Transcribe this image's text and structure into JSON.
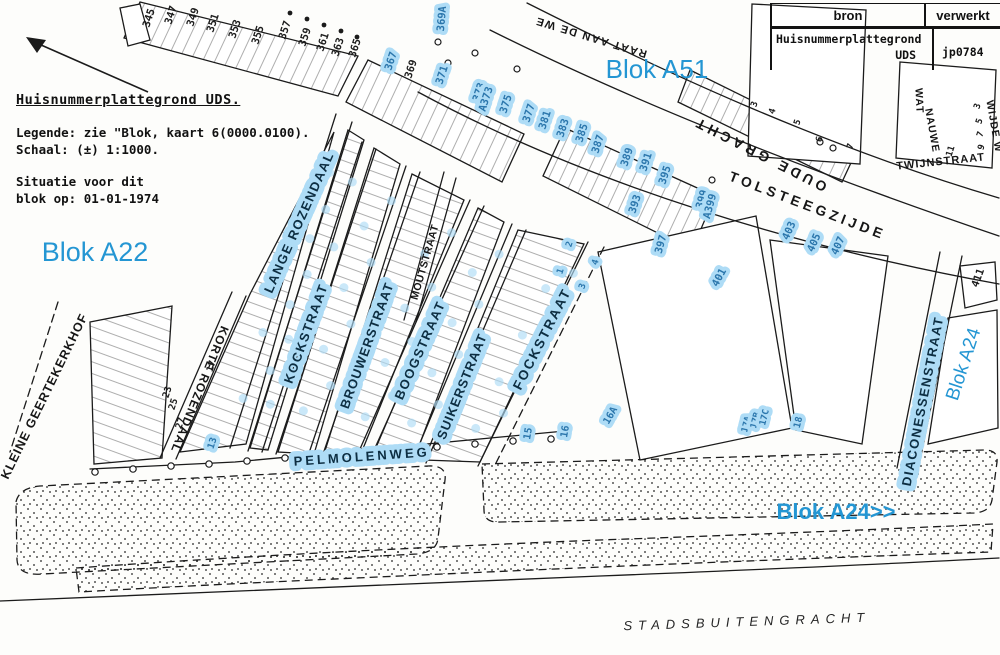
{
  "colors": {
    "annotation_blue": "#2496d3",
    "highlight": "#aedcf6",
    "ink": "#1b1b1b"
  },
  "legend": {
    "title": "Huisnummerplattegrond UDS.",
    "line1": "Legende: zie \"Blok, kaart 6(0000.0100).",
    "line2": "Schaal: (±) 1:1000.",
    "line3": "Situatie voor dit",
    "line4": "blok op: 01-01-1974"
  },
  "info_table": {
    "col1_header": "bron",
    "col2_header": "verwerkt",
    "source_line1": "Huisnummerplattegrond",
    "source_line2": "UDS",
    "value": "jp0784"
  },
  "map": {
    "blok_labels": [
      {
        "text": "Blok A22",
        "x": 95,
        "y": 261,
        "size": 27,
        "rot": 0,
        "bold": false
      },
      {
        "text": "Blok A51",
        "x": 657,
        "y": 78,
        "size": 26,
        "rot": 0,
        "bold": false
      },
      {
        "text": "Blok A24>>",
        "x": 836,
        "y": 519,
        "size": 22,
        "rot": 0,
        "bold": true
      },
      {
        "text": "Blok A24",
        "x": 969,
        "y": 366,
        "size": 19,
        "rot": -72,
        "bold": false
      }
    ],
    "street_labels": [
      {
        "text": "KLEINE GEERTEKERKHOF",
        "x": 48,
        "y": 398,
        "rot": -64,
        "size": 12.5,
        "ls": 1,
        "hl": false
      },
      {
        "text": "KORTE ROZENDAAL",
        "x": 196,
        "y": 388,
        "rot": 112,
        "size": 12,
        "ls": 1,
        "hl": false
      },
      {
        "text": "LANGE ROZENDAAL",
        "x": 303,
        "y": 224,
        "rot": -66,
        "size": 13,
        "ls": 1.5,
        "hl": true
      },
      {
        "text": "KOCKSTRAAT",
        "x": 310,
        "y": 335,
        "rot": -70,
        "size": 13,
        "ls": 1.5,
        "hl": true
      },
      {
        "text": "MOUTSTRAAT",
        "x": 428,
        "y": 263,
        "rot": -74,
        "size": 10.5,
        "ls": 0.5,
        "hl": false
      },
      {
        "text": "BROUWERSTRAAT",
        "x": 371,
        "y": 347,
        "rot": -70,
        "size": 13,
        "ls": 1,
        "hl": true
      },
      {
        "text": "BOOGSTRAAT",
        "x": 424,
        "y": 352,
        "rot": -66,
        "size": 13,
        "ls": 1.5,
        "hl": true
      },
      {
        "text": "SUIKERSTRAAT",
        "x": 466,
        "y": 388,
        "rot": -68,
        "size": 13,
        "ls": 1,
        "hl": true
      },
      {
        "text": "FOCKSTRAAT",
        "x": 546,
        "y": 341,
        "rot": -63,
        "size": 13.5,
        "ls": 2,
        "hl": true
      },
      {
        "text": "OUDE GRACHT",
        "x": 762,
        "y": 150,
        "rot": 207,
        "size": 14,
        "ls": 4,
        "hl": false
      },
      {
        "text": "TOLSTEEGZIJDE",
        "x": 806,
        "y": 210,
        "rot": 21,
        "size": 14,
        "ls": 4,
        "hl": false
      },
      {
        "text": "DIACONESSENSTRAAT",
        "x": 927,
        "y": 402,
        "rot": -79,
        "size": 13,
        "ls": 1.5,
        "hl": true
      },
      {
        "text": "PELMOLENWEG",
        "x": 362,
        "y": 461,
        "rot": -4,
        "size": 13,
        "ls": 3,
        "hl": true
      },
      {
        "text": "TWIJNSTRAAT",
        "x": 941,
        "y": 165,
        "rot": -6,
        "size": 11,
        "ls": 1,
        "hl": false
      },
      {
        "text": "NAUWE",
        "x": 929,
        "y": 131,
        "rot": 80,
        "size": 10.5,
        "ls": 1,
        "hl": false
      },
      {
        "text": "WAT",
        "x": 916,
        "y": 101,
        "rot": 87,
        "size": 10.5,
        "ls": 1,
        "hl": false
      },
      {
        "text": "WIJDE W",
        "x": 991,
        "y": 127,
        "rot": 80,
        "size": 10.5,
        "ls": 1,
        "hl": false
      }
    ],
    "partial_label": {
      "text": "RAAT AAN DE WE",
      "x": 592,
      "y": 34,
      "rot": 197,
      "size": 11,
      "ls": 1.5
    },
    "waterway_label": {
      "text": "STADSBUITENGRACHT",
      "x": 747,
      "y": 626,
      "rot": -2,
      "size": 13,
      "ls": 6
    },
    "house_numbers": [
      {
        "t": "345",
        "x": 152,
        "y": 19
      },
      {
        "t": "347",
        "x": 174,
        "y": 16
      },
      {
        "t": "349",
        "x": 196,
        "y": 18
      },
      {
        "t": "351",
        "x": 216,
        "y": 24
      },
      {
        "t": "353",
        "x": 238,
        "y": 30
      },
      {
        "t": "355",
        "x": 261,
        "y": 36
      },
      {
        "t": "357",
        "x": 288,
        "y": 31
      },
      {
        "t": "359",
        "x": 308,
        "y": 38
      },
      {
        "t": "361",
        "x": 326,
        "y": 43
      },
      {
        "t": "363",
        "x": 341,
        "y": 48
      },
      {
        "t": "365",
        "x": 358,
        "y": 49
      },
      {
        "t": "367",
        "x": 394,
        "y": 62,
        "hl": 1
      },
      {
        "t": "369",
        "x": 414,
        "y": 70
      },
      {
        "t": "369A",
        "x": 445,
        "y": 19,
        "hl": 1,
        "r": -85
      },
      {
        "t": "371",
        "x": 445,
        "y": 76,
        "hl": 1
      },
      {
        "t": "373",
        "x": 482,
        "y": 93,
        "hl": 1
      },
      {
        "t": "A373",
        "x": 489,
        "y": 100,
        "hl": 1
      },
      {
        "t": "375",
        "x": 509,
        "y": 105,
        "hl": 1
      },
      {
        "t": "377",
        "x": 532,
        "y": 114,
        "hl": 1
      },
      {
        "t": "381",
        "x": 548,
        "y": 121,
        "hl": 1
      },
      {
        "t": "383",
        "x": 566,
        "y": 129,
        "hl": 1
      },
      {
        "t": "385",
        "x": 585,
        "y": 134,
        "hl": 1
      },
      {
        "t": "387",
        "x": 601,
        "y": 145,
        "hl": 1
      },
      {
        "t": "389",
        "x": 630,
        "y": 158,
        "hl": 1
      },
      {
        "t": "391",
        "x": 649,
        "y": 163,
        "hl": 1
      },
      {
        "t": "395",
        "x": 668,
        "y": 176,
        "hl": 1
      },
      {
        "t": "393",
        "x": 638,
        "y": 205,
        "hl": 1
      },
      {
        "t": "397",
        "x": 664,
        "y": 245,
        "hl": 1,
        "r": -75
      },
      {
        "t": "399",
        "x": 705,
        "y": 200,
        "hl": 1,
        "r": -75
      },
      {
        "t": "A399",
        "x": 713,
        "y": 207,
        "hl": 1,
        "r": -75
      },
      {
        "t": "401",
        "x": 722,
        "y": 279,
        "hl": 1,
        "r": -62
      },
      {
        "t": "403",
        "x": 792,
        "y": 232,
        "hl": 1,
        "r": -66
      },
      {
        "t": "405",
        "x": 817,
        "y": 244,
        "hl": 1,
        "r": -66
      },
      {
        "t": "407",
        "x": 841,
        "y": 247,
        "hl": 1,
        "r": -66
      },
      {
        "t": "411",
        "x": 981,
        "y": 279,
        "r": -70
      },
      {
        "t": "3",
        "x": 757,
        "y": 105,
        "s": 9
      },
      {
        "t": "4",
        "x": 775,
        "y": 112,
        "s": 9
      },
      {
        "t": "5",
        "x": 800,
        "y": 123,
        "s": 9
      },
      {
        "t": "6",
        "x": 822,
        "y": 140,
        "s": 9
      },
      {
        "t": "7",
        "x": 853,
        "y": 147,
        "s": 9
      },
      {
        "t": "3",
        "x": 980,
        "y": 107,
        "s": 9
      },
      {
        "t": "5",
        "x": 982,
        "y": 122,
        "s": 9
      },
      {
        "t": "7",
        "x": 983,
        "y": 135,
        "s": 9
      },
      {
        "t": "9",
        "x": 984,
        "y": 148,
        "s": 9
      },
      {
        "t": "11",
        "x": 953,
        "y": 152,
        "s": 9
      },
      {
        "t": "17",
        "x": 214,
        "y": 367,
        "s": 9.5
      },
      {
        "t": "23",
        "x": 170,
        "y": 393,
        "s": 9.5
      },
      {
        "t": "25",
        "x": 176,
        "y": 405,
        "s": 9.5
      },
      {
        "t": "27",
        "x": 183,
        "y": 424,
        "s": 9.5
      },
      {
        "t": "13",
        "x": 215,
        "y": 444,
        "hl": 1,
        "s": 9.5
      },
      {
        "t": "1",
        "x": 563,
        "y": 272,
        "hl": 1,
        "s": 9
      },
      {
        "t": "2",
        "x": 572,
        "y": 245,
        "hl": 1,
        "s": 9
      },
      {
        "t": "3",
        "x": 585,
        "y": 287,
        "hl": 1,
        "s": 9
      },
      {
        "t": "4",
        "x": 598,
        "y": 263,
        "hl": 1,
        "s": 9
      },
      {
        "t": "15",
        "x": 531,
        "y": 434,
        "hl": 1,
        "s": 10,
        "r": -80
      },
      {
        "t": "16",
        "x": 568,
        "y": 432,
        "hl": 1,
        "s": 10,
        "r": -80
      },
      {
        "t": "16A",
        "x": 613,
        "y": 417,
        "hl": 1,
        "s": 10,
        "r": -60
      },
      {
        "t": "17A",
        "x": 749,
        "y": 425,
        "hl": 1,
        "s": 9,
        "r": -76
      },
      {
        "t": "17B",
        "x": 758,
        "y": 421,
        "hl": 1,
        "s": 9,
        "r": -76
      },
      {
        "t": "17C",
        "x": 767,
        "y": 418,
        "hl": 1,
        "s": 9,
        "r": -76
      },
      {
        "t": "18",
        "x": 801,
        "y": 423,
        "hl": 1,
        "s": 9.5,
        "r": -76
      }
    ]
  }
}
